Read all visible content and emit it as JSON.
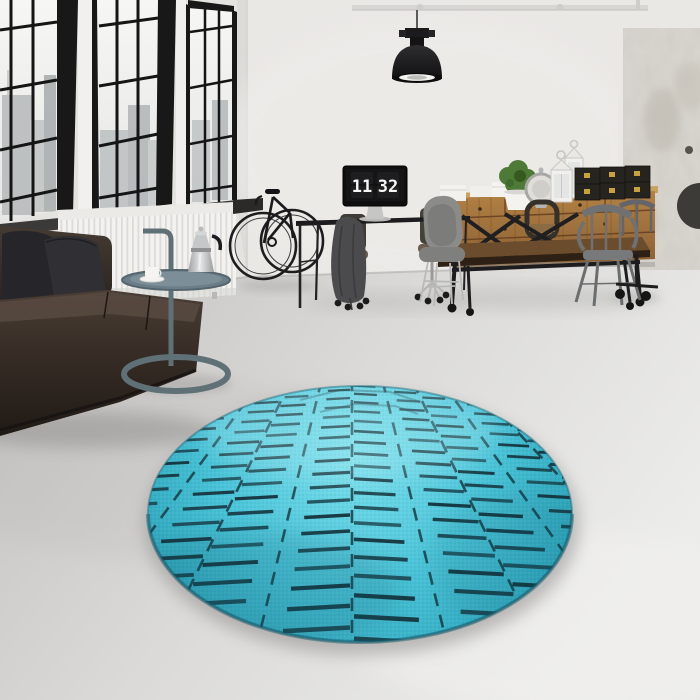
{
  "meta": {
    "description": "Photograph of a round turquoise chevron-pattern rug on a concrete floor in a white industrial loft interior",
    "scene_type": "product-photo"
  },
  "monitor": {
    "time_hours": "11",
    "time_minutes": "32"
  },
  "colors": {
    "wall": "#eae8e5",
    "wall_left": "#e4e3e0",
    "floor_dark": "#c2c1bf",
    "floor_mid": "#dbdad8",
    "floor_light": "#ececea",
    "window_frame": "#151515",
    "glass": "#f3f3f1",
    "city": "#b2b6b8",
    "radiator": "#f3f2f0",
    "sofa_dark": "#241d18",
    "sofa_mid": "#3c332c",
    "sofa_light": "#564940",
    "pillow": "#28282c",
    "side_table": "#5f7077",
    "metal_light": "#d8dadb",
    "metal_mid": "#a9abad",
    "bike": "#1a1a1c",
    "desk": "#1c1c1e",
    "monitor_screen": "#121214",
    "clock_digits": "#f7f7f5",
    "wood_light": "#b08044",
    "wood_dark": "#8a5e31",
    "table_wood": "#53391f",
    "chair_grey": "#8b8b89",
    "chair_metal": "#73757a",
    "box_black": "#26241f",
    "box_gold": "#c9a23f",
    "plant": "#4e7a38",
    "lantern": "#f1f0ed",
    "lamp": "#1f1f21",
    "rug_light": "#79dfec",
    "rug_base": "#49c3d8",
    "rug_deep": "#2ba2b8",
    "rug_line": "#14333c",
    "rug_shadow": "#8e8d8b",
    "column": "#d9d6d0"
  },
  "rug": {
    "cx": 360,
    "cy": 514,
    "rx": 212,
    "ry": 128,
    "vp": {
      "x": 352,
      "y": 256
    },
    "anchors": [
      92,
      156,
      222,
      288,
      352,
      416,
      480,
      544,
      608,
      668
    ],
    "row_start": 378,
    "row_end": 655,
    "row_factor": 0.062,
    "gap_fraction": 0.24,
    "dash_min_width": 2.1,
    "dash_width_growth": 0.01,
    "droop": 0.055
  },
  "scene": {
    "objects": [
      {
        "name": "round-rug",
        "label": "turquoise round rug with dark chevron dashes"
      },
      {
        "name": "sofa",
        "label": "dark brown leather sofa with two dark pillows"
      },
      {
        "name": "side-table",
        "label": "grey-blue loop-base tray side table"
      },
      {
        "name": "moka-pot",
        "label": "silver stovetop espresso maker"
      },
      {
        "name": "coffee-cup",
        "label": "white cup and saucer"
      },
      {
        "name": "bicycle",
        "label": "black bicycle on wall rack"
      },
      {
        "name": "windows",
        "label": "three black-framed industrial windows with city view"
      },
      {
        "name": "radiator",
        "label": "white panel radiator"
      },
      {
        "name": "pendant-lamp",
        "label": "black industrial pendant lamp"
      },
      {
        "name": "monitor-clock",
        "label": "monitor showing flip clock 11 32"
      },
      {
        "name": "office-desk",
        "label": "black desk with two task chairs and draped jacket"
      },
      {
        "name": "dining-table",
        "label": "industrial wood dining table with X-frame legs"
      },
      {
        "name": "dining-chairs",
        "label": "grey shell chair and grey metal armchairs"
      },
      {
        "name": "sideboard",
        "label": "wooden drawer sideboard"
      },
      {
        "name": "storage-boxes",
        "label": "black storage boxes with gold clasps"
      },
      {
        "name": "lanterns",
        "label": "white candle lanterns"
      },
      {
        "name": "plant",
        "label": "green plant in white pot"
      },
      {
        "name": "textured-column",
        "label": "distressed plaster column"
      },
      {
        "name": "concrete-floor",
        "label": "light grey concrete floor"
      }
    ]
  }
}
